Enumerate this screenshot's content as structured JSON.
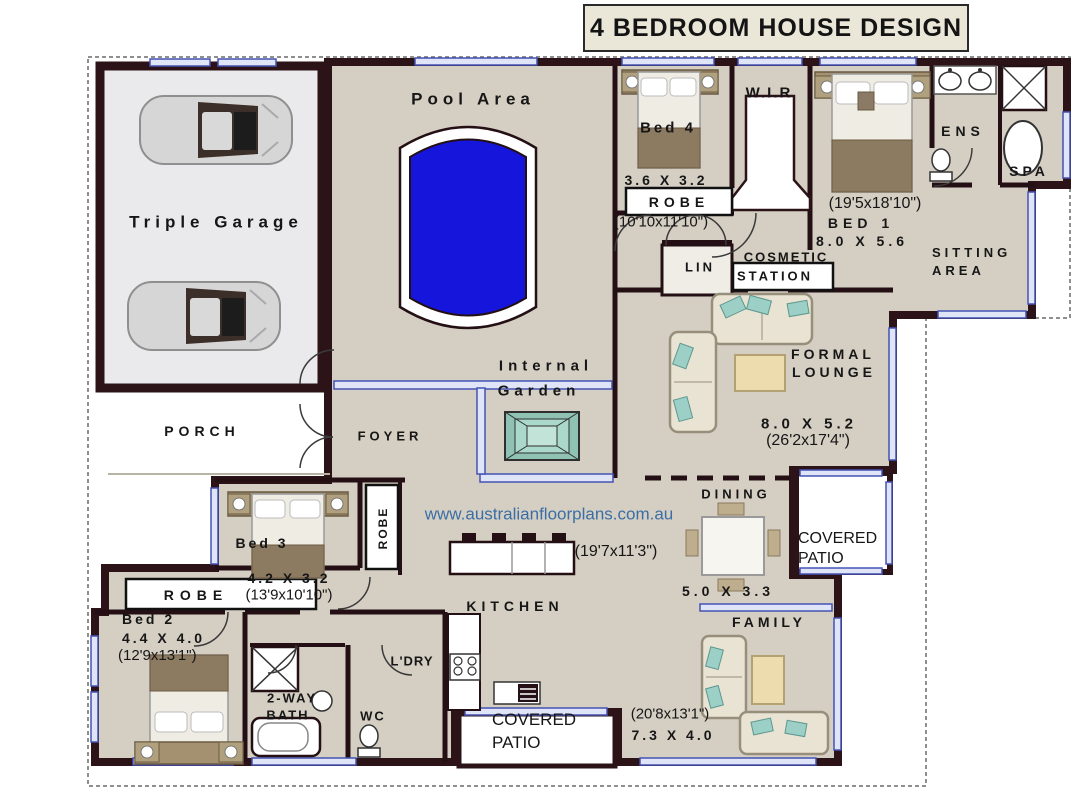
{
  "title": "4 BEDROOM HOUSE DESIGN",
  "watermark": "www.australianfloorplans.com.au",
  "colors": {
    "floor": "#d5cfc3",
    "wall": "#2c1317",
    "pool": "#1515dc",
    "window_blue": "#4553b4",
    "garden_teal": "#aad8ca",
    "watermark_blue": "#3a6ea5",
    "title_background": "#eae6d8"
  },
  "rooms": {
    "pool_area": {
      "label": "Pool Area"
    },
    "garage": {
      "label": "Triple Garage"
    },
    "porch": {
      "label": "PORCH"
    },
    "foyer": {
      "label": "FOYER"
    },
    "internal_garden": {
      "line1": "Internal",
      "line2": "Garden"
    },
    "bed4": {
      "label": "Bed 4",
      "metric": "3.6 X 3.2",
      "imperial": "(10'10x11'10\")",
      "robe": "ROBE"
    },
    "wir": {
      "label": "W.I.R"
    },
    "bed1": {
      "label": "BED 1",
      "metric": "8.0 X 5.6",
      "imperial": "(19'5x18'10\")"
    },
    "ens": {
      "label": "ENS"
    },
    "spa": {
      "label": "SPA"
    },
    "sitting_area": {
      "line1": "SITTING",
      "line2": "AREA"
    },
    "lin": {
      "label": "LIN"
    },
    "cosmetic_station": {
      "line1": "COSMETIC",
      "line2": "STATION"
    },
    "formal_lounge": {
      "line1": "FORMAL",
      "line2": "LOUNGE",
      "metric": "8.0 X 5.2",
      "imperial": "(26'2x17'4\")"
    },
    "dining": {
      "label": "DINING",
      "metric": "5.0 X 3.3",
      "imperial": "(19'7x11'3\")"
    },
    "covered_patio_right": {
      "line1": "COVERED",
      "line2": "PATIO"
    },
    "covered_patio_bottom": {
      "line1": "COVERED",
      "line2": "PATIO"
    },
    "kitchen": {
      "label": "KITCHEN"
    },
    "laundry": {
      "label": "L'DRY"
    },
    "two_way_bath": {
      "line1": "2-WAY",
      "line2": "BATH"
    },
    "wc": {
      "label": "WC"
    },
    "bed3": {
      "label": "Bed 3",
      "metric": "4.2 X 3.2",
      "imperial": "(13'9x10'10\")",
      "robe_vertical": "ROBE"
    },
    "robe_left": {
      "label": "ROBE"
    },
    "bed2": {
      "label": "Bed 2",
      "metric": "4.4 X 4.0",
      "imperial": "(12'9x13'1\")"
    },
    "family": {
      "label": "FAMILY",
      "metric": "7.3 X 4.0",
      "imperial": "(20'8x13'1\")"
    }
  }
}
